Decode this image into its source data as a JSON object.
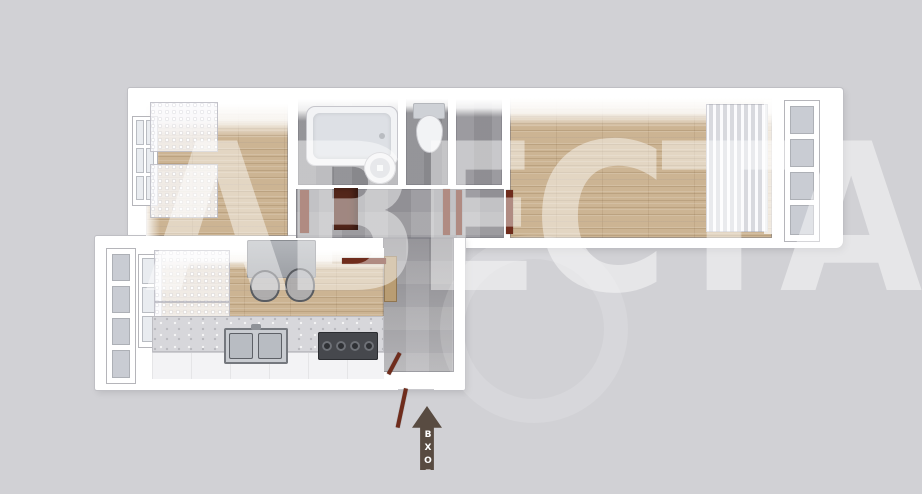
{
  "watermark": {
    "text": "АВЕСТА"
  },
  "entrance": {
    "label": "ВХОД"
  },
  "colors": {
    "bg": "#d1d1d5",
    "wall": "#ffffff",
    "wall-edge": "#bfbfc4",
    "wood": "#ccb493",
    "tile": "#a2a1a6",
    "bathfloor": "#8f8f94",
    "door": "#6f2c1c",
    "cabinet": "#53261a",
    "arrow": "#584b41",
    "arrow-text": "#ffffff",
    "glass": "#c9ccd3",
    "fixture": "#f2f3f5",
    "counter": "#d7d7db",
    "table": "#a9acb1",
    "stove": "#46484d",
    "wm": "rgba(255,255,255,0.45)"
  }
}
